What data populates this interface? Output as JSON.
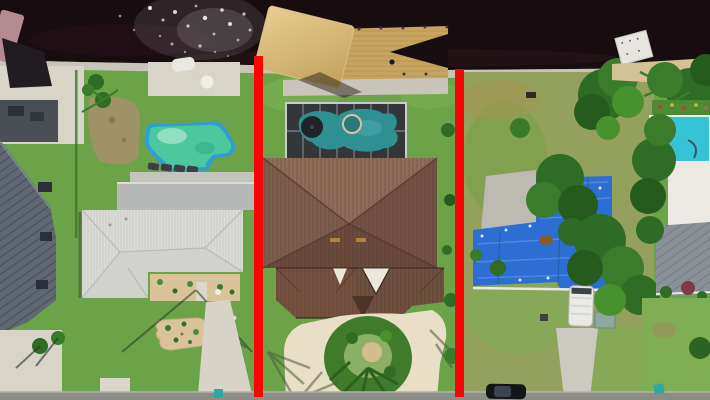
{
  "meta": {
    "kind": "aerial-drone-photograph",
    "subject": "Top-down aerial photo of waterfront residential lots on a dark canal; the center lot is marked with two vertical red property-boundary lines",
    "canvas": {
      "width": 710,
      "height": 400
    }
  },
  "annotation": {
    "boundary_color": "#f60606",
    "lines": [
      {
        "id": "left-property-boundary",
        "x": 254,
        "y_top": 56,
        "y_bottom": 397,
        "width": 9
      },
      {
        "id": "right-property-boundary",
        "x": 455,
        "y_top": 69,
        "y_bottom": 397,
        "width": 9
      }
    ]
  },
  "scene": {
    "canal_water": "#170c10",
    "sun_glint": "#ffffff",
    "seawall": "#c9c4b8",
    "grass": "#6ca348",
    "street": "#8d8d87",
    "far_left_neighbor": {
      "metal_roof": "#5f6873",
      "boat_canopy": "#b48b90",
      "pavers": "#d9d4c8"
    },
    "left_lot": {
      "house_roof": "#dbdbd7",
      "lanai_roof": "#b6b9b8",
      "pool_water": "#4cc79e",
      "pool_trim": "#2f9fd0",
      "pool_deck": "#c4c4bf",
      "sand_bed": "#d9c499",
      "driveway": "#d7d3c6"
    },
    "center_lot": {
      "boat_canopy": "#dcbe7e",
      "dock_wood": "#c7a55e",
      "screen_enclosure": "#33373a",
      "pool_water": "#2f9092",
      "house_roof": "#7b5a49",
      "gable_accent": "#ece7da",
      "driveway_pavers": "#e8dfc6",
      "landscape_ring": "#3f7b2b"
    },
    "right_lot": {
      "tarp_roof": "#2d6ed3",
      "lawn": "#93a15c",
      "rv_trailer": "#e9e9e5",
      "driveway": "#ccc9c0",
      "shed": "#8fa89e",
      "car": "#141519"
    },
    "far_right_neighbor": {
      "pool_water": "#36c3d5",
      "pool_deck": "#ebe9e1",
      "house_roof": "#8b9297",
      "flower_shrub": "#7b3b4b"
    },
    "trees": {
      "dark": "#255c1e",
      "mid": "#2f6d26",
      "light": "#47922f"
    }
  }
}
